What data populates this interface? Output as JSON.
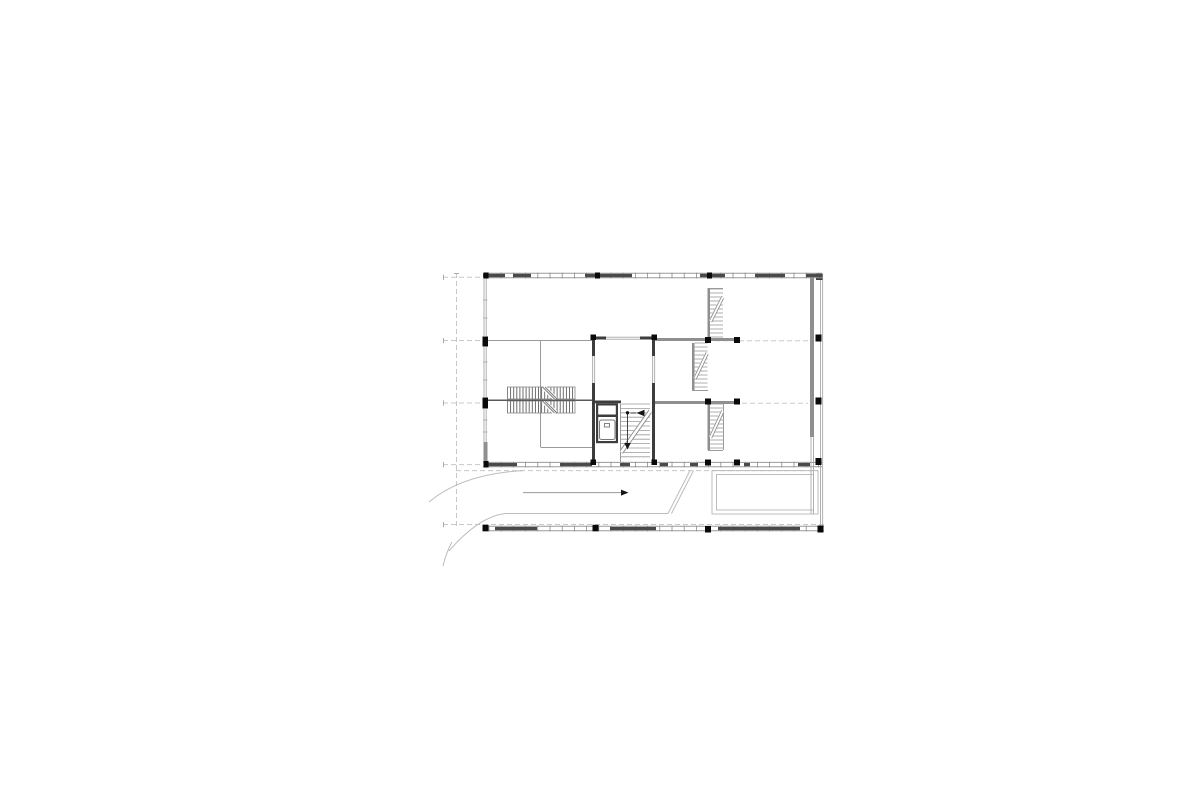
{
  "canvas": {
    "width": 1200,
    "height": 804,
    "background": "#ffffff"
  },
  "colors": {
    "wall_dark": "#3d3d3d",
    "wall_gray": "#8f8f8f",
    "thin_line": "#9a9a9a",
    "window_line": "#b0b0b0",
    "dashed_line": "#c8c8c8",
    "tread_line": "#9a9a9a",
    "hatch_line": "#5f5f5f",
    "facade_dark": "#4a4a4a",
    "facade_tick": "#8a8a8a",
    "column_black": "#0a0a0a",
    "site_line": "#bcbcbc",
    "arrow_line": "#999999",
    "arrow_head": "#151515"
  },
  "plan": {
    "walls_gray": [
      [
        810,
        276,
        4,
        161
      ],
      [
        655,
        338,
        82,
        3
      ],
      [
        692,
        343,
        2.5,
        47
      ],
      [
        707.5,
        288,
        2.5,
        50
      ],
      [
        707.5,
        404,
        2.5,
        46
      ],
      [
        655,
        401,
        82,
        3
      ],
      [
        483.5,
        442,
        4,
        23
      ]
    ],
    "walls_dark": [
      [
        592,
        336.5,
        14,
        3
      ],
      [
        640,
        336.5,
        15,
        3
      ],
      [
        592,
        339,
        3,
        17
      ],
      [
        592,
        383,
        3,
        20
      ],
      [
        652,
        339,
        3,
        17
      ],
      [
        652,
        383,
        3,
        20
      ],
      [
        592,
        400.5,
        29,
        2.8
      ],
      [
        592,
        403,
        3,
        60
      ],
      [
        652,
        403,
        3,
        60
      ],
      [
        596,
        403.3,
        22,
        2.2
      ],
      [
        596,
        414.5,
        22,
        2.5
      ],
      [
        596,
        405,
        2.2,
        38
      ],
      [
        615.8,
        405,
        2.2,
        38
      ],
      [
        596,
        441,
        22,
        2.2
      ],
      [
        816,
        273,
        6.5,
        7
      ]
    ],
    "thin_lines": [
      [
        487,
        340.5,
        592,
        340.5
      ],
      [
        540.5,
        340,
        540.5,
        447
      ],
      [
        540.5,
        447.5,
        592,
        447.5
      ],
      [
        708,
        288.5,
        723,
        288.5
      ],
      [
        692,
        390.5,
        708,
        390.5
      ],
      [
        708,
        450.5,
        723,
        450.5
      ],
      [
        723.5,
        404,
        723.5,
        450
      ],
      [
        620.5,
        404,
        620.5,
        462
      ]
    ],
    "window_lines": [
      [
        484,
        278,
        484,
        336
      ],
      [
        486.2,
        278,
        486.2,
        336
      ],
      [
        484,
        347,
        484,
        397
      ],
      [
        486.2,
        347,
        486.2,
        397
      ],
      [
        484,
        409,
        484,
        442
      ],
      [
        486.2,
        409,
        486.2,
        442
      ],
      [
        604,
        337.3,
        640,
        337.3
      ],
      [
        604,
        339.3,
        640,
        339.3
      ],
      [
        592.6,
        356,
        592.6,
        383
      ],
      [
        594.6,
        356,
        594.6,
        383
      ],
      [
        652.6,
        356,
        652.6,
        383
      ],
      [
        654.6,
        356,
        654.6,
        383
      ],
      [
        820.5,
        274,
        820.5,
        531
      ],
      [
        822.6,
        274,
        822.6,
        531
      ],
      [
        811,
        437,
        811,
        514
      ],
      [
        813.5,
        437,
        813.5,
        514
      ],
      [
        483,
        300,
        487.5,
        300
      ],
      [
        483,
        318,
        487.5,
        318
      ],
      [
        483,
        362,
        487.5,
        362
      ],
      [
        483,
        380,
        487.5,
        380
      ],
      [
        483,
        420,
        487.5,
        420
      ],
      [
        483,
        432,
        487.5,
        432
      ]
    ],
    "dashed_lines": [
      [
        456.5,
        273,
        456.5,
        526
      ],
      [
        443,
        277.3,
        483,
        277.3
      ],
      [
        443,
        340.5,
        483,
        340.5
      ],
      [
        715,
        340.8,
        808,
        340.8
      ],
      [
        443,
        403,
        483,
        403
      ],
      [
        742,
        403.3,
        808,
        403.3
      ],
      [
        443,
        464.6,
        483,
        464.6
      ],
      [
        456,
        470.6,
        818,
        470.6
      ],
      [
        443,
        524.5,
        824,
        524.5
      ]
    ],
    "grid_ticks": [
      [
        443.5,
        274.8,
        443.5,
        280
      ],
      [
        443.5,
        338,
        443.5,
        343.2
      ],
      [
        443.5,
        400.4,
        443.5,
        405.6
      ],
      [
        443.5,
        462,
        443.5,
        467.2
      ],
      [
        443.5,
        522,
        443.5,
        527.2
      ],
      [
        454,
        273.5,
        459,
        273.5
      ]
    ],
    "columns": [
      [
        590.5,
        334.5,
        5.5,
        5.5
      ],
      [
        651.5,
        334.5,
        5.5,
        5.5
      ],
      [
        590.5,
        459.5,
        5.5,
        5.5
      ],
      [
        651.5,
        459.5,
        5.5,
        5.5
      ],
      [
        705,
        337,
        6,
        6
      ],
      [
        734,
        337,
        6,
        6
      ],
      [
        705,
        398.5,
        6,
        6
      ],
      [
        734,
        398.5,
        6,
        6
      ],
      [
        705,
        459.5,
        6,
        6
      ],
      [
        734,
        459.5,
        6,
        6
      ],
      [
        815.5,
        334.5,
        6,
        7
      ],
      [
        815.5,
        397.5,
        6,
        7
      ],
      [
        815.5,
        458,
        6,
        7
      ],
      [
        482.5,
        336.5,
        5.5,
        10
      ],
      [
        482.5,
        397.5,
        5.5,
        11
      ]
    ],
    "facades": [
      {
        "x1": 483,
        "x2": 822.5,
        "y1": 273.2,
        "y2": 277.8,
        "tick_step": 12.2,
        "dark_segments": [
          [
            483,
            22
          ],
          [
            513,
            18
          ],
          [
            585,
            47
          ],
          [
            700,
            25
          ],
          [
            755,
            30
          ],
          [
            806,
            16
          ]
        ],
        "posts": [
          [
            483.5,
            272.5,
            5,
            6
          ],
          [
            595,
            272.5,
            5,
            6
          ],
          [
            707,
            272.5,
            5,
            6
          ]
        ]
      },
      {
        "x1": 483,
        "x2": 822,
        "y1": 462.4,
        "y2": 466.8,
        "tick_step": 12.2,
        "dark_segments": [
          [
            487,
            30
          ],
          [
            560,
            32
          ],
          [
            620,
            10
          ],
          [
            660,
            8
          ],
          [
            690,
            8
          ],
          [
            744,
            6
          ],
          [
            798,
            12
          ]
        ],
        "posts": [
          [
            483.5,
            461,
            5,
            6.5
          ]
        ]
      },
      {
        "x1": 483,
        "x2": 824,
        "y1": 526.3,
        "y2": 530.8,
        "tick_step": 12.2,
        "dark_segments": [
          [
            495,
            42
          ],
          [
            610,
            46
          ],
          [
            718,
            55
          ],
          [
            772,
            28
          ]
        ],
        "posts": [
          [
            482.5,
            524.8,
            6,
            6.5
          ],
          [
            592.5,
            524.8,
            6,
            6.5
          ],
          [
            705,
            526,
            6,
            6.5
          ],
          [
            817.5,
            525.5,
            6,
            7
          ]
        ]
      }
    ],
    "stairs": {
      "left_double": {
        "x": 507.5,
        "y": 387,
        "w": 67.5,
        "band_h": 12,
        "gap": 2,
        "hatch_step": 3.1,
        "break_offset": 36,
        "break_w": 12,
        "center_line": [
          485,
          400.2,
          592,
          400.2
        ]
      },
      "core_stair": {
        "x": 621,
        "y": 404,
        "w": 29,
        "h": 57,
        "step": 4.4,
        "diag": [
          621,
          452,
          650,
          411
        ],
        "dot": [
          627.5,
          412.8
        ],
        "line_v": [
          627.5,
          414.5,
          627.5,
          443
        ],
        "tri_down": [
          [
            624.3,
            443
          ],
          [
            630.7,
            443
          ],
          [
            627.5,
            449.5
          ]
        ],
        "tri_left": [
          [
            644.5,
            409.8
          ],
          [
            644.5,
            416.2
          ],
          [
            636.5,
            413
          ]
        ],
        "line_h": [
          630.5,
          413,
          636,
          413
        ]
      },
      "runs": [
        {
          "x": 710,
          "y": 289,
          "w": 13,
          "h": 48,
          "step": 4,
          "diag": [
            710.5,
            321,
            722.5,
            297
          ]
        },
        {
          "x": 694.5,
          "y": 343,
          "w": 13,
          "h": 47,
          "step": 4,
          "diag": [
            695,
            378,
            707,
            353
          ]
        },
        {
          "x": 710,
          "y": 404,
          "w": 13,
          "h": 46,
          "step": 4,
          "diag": [
            710.5,
            437,
            722.5,
            411
          ]
        }
      ]
    },
    "elevator": {
      "x": 599.5,
      "y": 420,
      "w": 15.5,
      "h": 19.5,
      "rx": 2,
      "tick": [
        604.5,
        423.5,
        5,
        3.5
      ]
    },
    "site": {
      "curves": [
        "M429,502 Q462,474 523,470.6",
        "M449,551 Q478,517 505,513.5 L668,513.5",
        "M452,542 Q446,553 443,566"
      ],
      "ramp_diagonals": [
        [
          690,
          470.6,
          668,
          513.5
        ],
        [
          693.5,
          470.6,
          671.5,
          513.5
        ]
      ],
      "terrace_rects": [
        [
          712,
          470.6,
          106,
          43.4
        ],
        [
          716.5,
          474.5,
          97,
          35.5
        ]
      ],
      "arrow": {
        "line": [
          523,
          492.6,
          621,
          492.6
        ],
        "head": [
          [
            621,
            489.6
          ],
          [
            621,
            495.6
          ],
          [
            628.5,
            492.6
          ]
        ]
      }
    }
  }
}
